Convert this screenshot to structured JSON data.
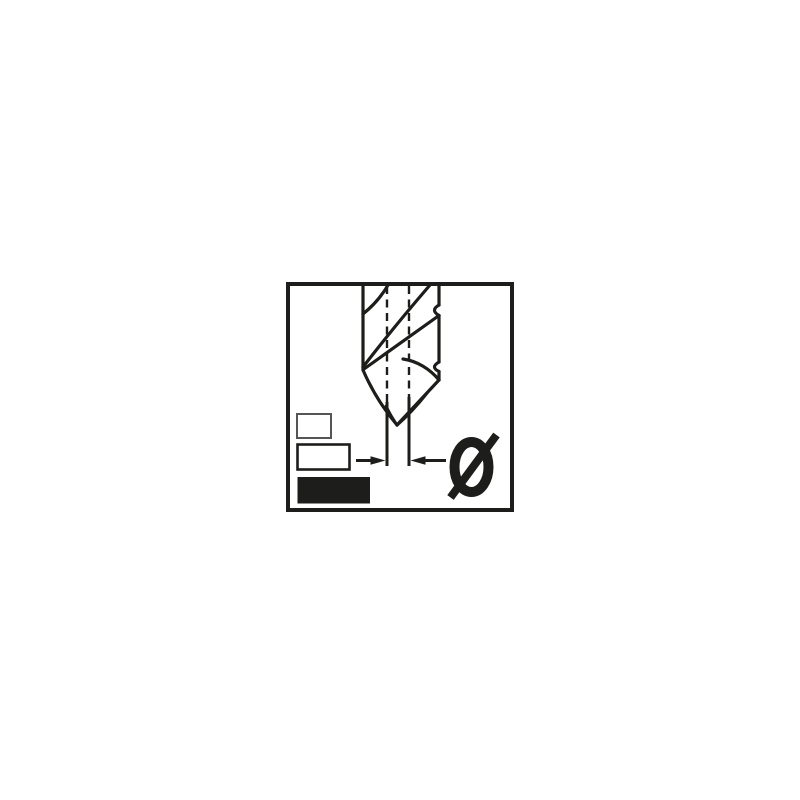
{
  "page": {
    "background": "#ffffff"
  },
  "pictogram": {
    "kind": "drill-bit-diameter-pictogram",
    "diameter_symbol": "Ø",
    "diameter_symbol_label": "Diameter symbol",
    "colors": {
      "ink": "#1d1d1b",
      "background": "#ffffff",
      "small_box_border": "#555555",
      "large_box_fill": "#1d1d1b"
    },
    "icons": {
      "drill": "twist-drill-bit-icon",
      "centerlines": "dashed-centerlines",
      "dimension": "diameter-dimension-arrows",
      "size_boxes": [
        "small-outline-box",
        "medium-outline-box",
        "large-filled-box"
      ]
    }
  }
}
